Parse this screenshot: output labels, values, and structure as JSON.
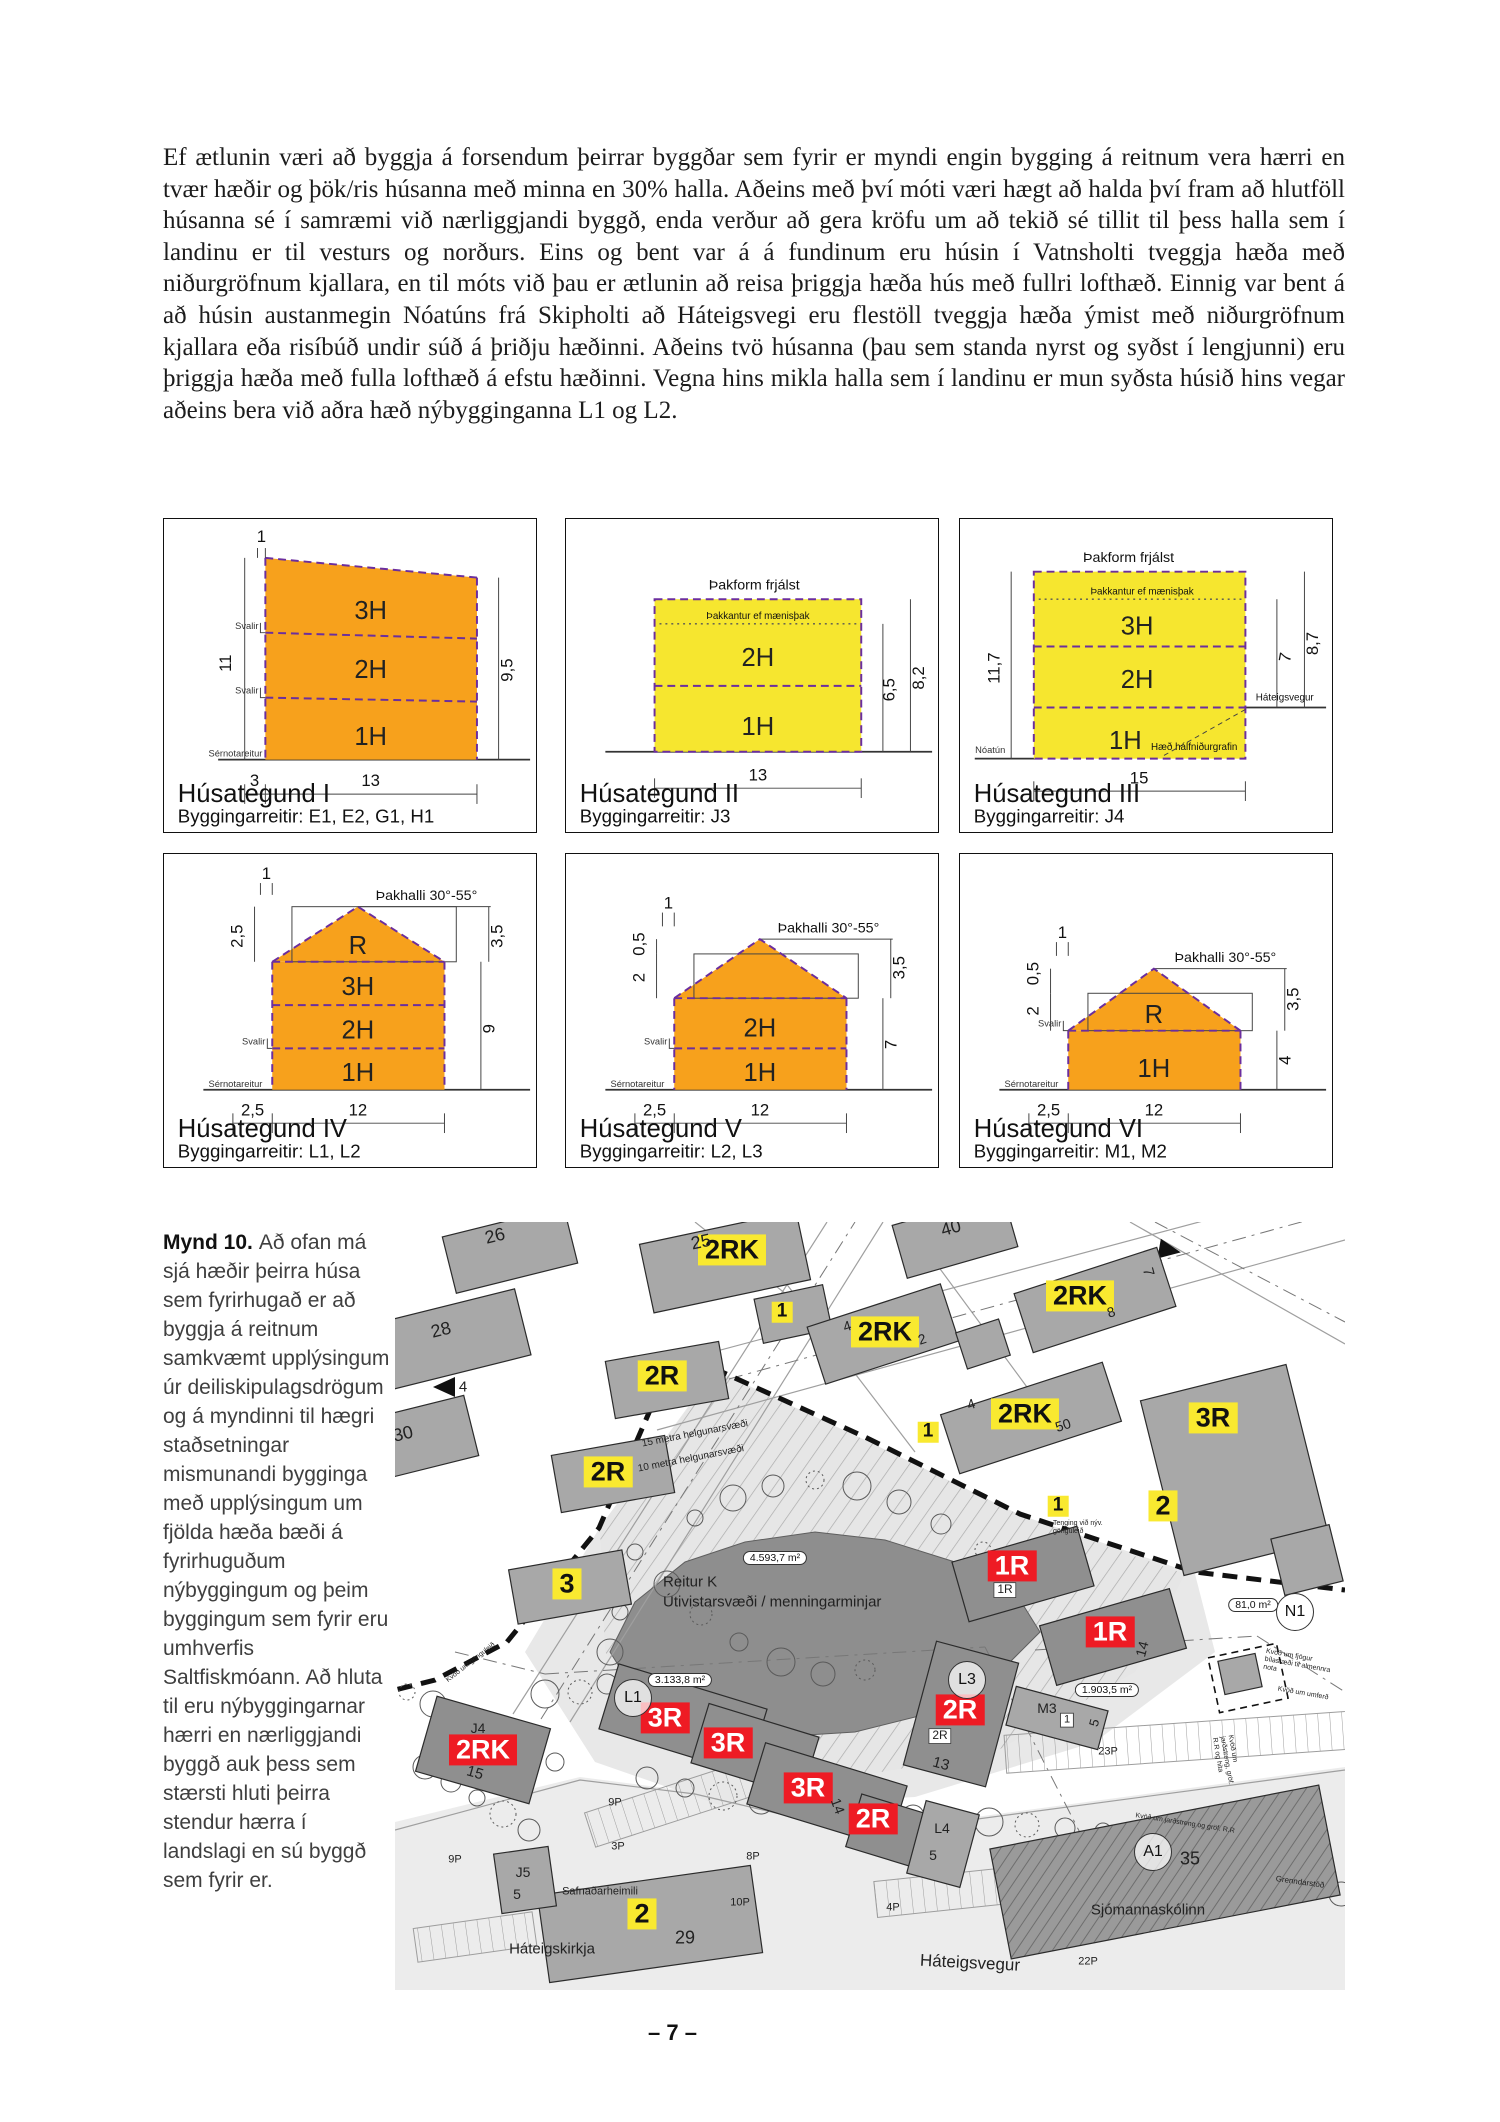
{
  "page": {
    "number": "– 7 –"
  },
  "paragraph": "Ef ætlunin væri að byggja á forsendum þeirrar byggðar sem fyrir er myndi engin bygging á reitnum vera hærri en tvær hæðir og þök/ris húsanna með minna en 30% halla. Aðeins með því móti væri hægt að halda því fram að hlutföll húsanna sé í samræmi við nærliggjandi byggð, enda verður að gera kröfu um að tekið sé tillit til þess halla sem í landinu er til vesturs og norðurs. Eins og bent var á á fundinum eru húsin í Vatnsholti tveggja hæða með niðurgröfnum kjallara, en til móts við þau er ætlunin að reisa þriggja hæða hús með fullri lofthæð. Einnig var bent á að húsin austanmegin Nóatúns frá Skipholti að Háteigsvegi eru flestöll tveggja hæða ýmist með niðurgröfnum kjallara eða risíbúð undir súð á þriðju hæðinni. Aðeins tvö húsanna (þau sem standa nyrst og syðst í lengjunni) eru þriggja hæða með fulla lofthæð á efstu hæðinni. Vegna hins mikla halla sem í landinu er mun syðsta húsið hins vegar aðeins bera við aðra hæð nýbygginganna L1 og L2.",
  "colors": {
    "orange": "#F7A11C",
    "yellow": "#F6E62F",
    "marker_yellow": "#F9E930",
    "marker_red": "#EE1B24",
    "dash_purple": "#6B2E9E"
  },
  "panels": [
    {
      "title": "Húsategund I",
      "subtitle": "Byggingarreitir: E1, E2, G1, H1",
      "floors": [
        "3H",
        "2H",
        "1H"
      ],
      "labels": {
        "top": "1",
        "left": "11",
        "right": "9,5",
        "bottom_left": "3",
        "bottom": "13",
        "svalir": "Svalir",
        "svalir2": "Svalir",
        "sernotareitur": "Sérnotareitur"
      }
    },
    {
      "title": "Húsategund II",
      "subtitle": "Byggingarreitir: J3",
      "floors": [
        "2H",
        "1H"
      ],
      "labels": {
        "roof_note": "Þakform frjálst",
        "edge_note": "Þakkantur ef mænisþak",
        "dim1": "6,5",
        "dim2": "8,2",
        "bottom": "13"
      }
    },
    {
      "title": "Húsategund III",
      "subtitle": "Byggingarreitir: J4",
      "floors": [
        "3H",
        "2H",
        "1H"
      ],
      "labels": {
        "roof_note": "Þakform frjálst",
        "edge_note": "Þakkantur ef mænisþak",
        "left": "11,7",
        "dim1": "7",
        "dim2": "8,7",
        "bottom": "15",
        "street_left": "Nóatún",
        "street_right": "Háteigsvegur",
        "basement_note": "Hæð hálfniðurgrafin"
      }
    },
    {
      "title": "Húsategund IV",
      "subtitle": "Byggingarreitir: L1, L2",
      "floors": [
        "R",
        "3H",
        "2H",
        "1H"
      ],
      "labels": {
        "top": "1",
        "roof_note": "Þakhalli 30°-55°",
        "left1": "2,5",
        "right1": "3,5",
        "right2": "9",
        "bottom_left": "2,5",
        "bottom": "12",
        "svalir": "Svalir",
        "sernotareitur": "Sérnotareitur"
      }
    },
    {
      "title": "Húsategund V",
      "subtitle": "Byggingarreitir: L2, L3",
      "floors": [
        "2H",
        "1H"
      ],
      "labels": {
        "top": "1",
        "roof_note": "Þakhalli 30°-55°",
        "left1": "0,5",
        "left2": "2",
        "right1": "3,5",
        "right2": "7",
        "bottom_left": "2,5",
        "bottom": "12",
        "svalir": "Svalir",
        "sernotareitur": "Sérnotareitur"
      }
    },
    {
      "title": "Húsategund VI",
      "subtitle": "Byggingarreitir: M1, M2",
      "floors": [
        "R",
        "1H"
      ],
      "labels": {
        "top": "1",
        "roof_note": "Þakhalli 30°-55°",
        "left1": "0,5",
        "left2": "2",
        "right1": "3,5",
        "right2": "4",
        "bottom_left": "2,5",
        "bottom": "12",
        "svalir": "Svalir",
        "sernotareitur": "Sérnotareitur"
      }
    }
  ],
  "figure": {
    "label": "Mynd 10.",
    "text": "Að ofan má sjá hæðir þeirra húsa sem fyrirhugað er að byggja á reitnum samkvæmt upplýsingum úr deiliskipulagsdrögum og á myndinni til hægri staðsetningar mismunandi bygginga með upplýsingum um fjölda hæða bæði á fyrirhuguðum nýbyggingum og þeim byggingum sem fyrir eru umhverfis Saltfiskmóann. Að hluta til eru nýbyggingarnar hærri en nærliggjandi byggð auk þess sem stærsti hluti þeirra stendur hærra í landslagi en sú byggð sem fyrir er."
  },
  "map": {
    "buildings": [
      {
        "x": 115,
        "y": 28,
        "w": 125,
        "h": 58,
        "r": -14
      },
      {
        "x": 55,
        "y": 118,
        "w": 150,
        "h": 68,
        "r": -14
      },
      {
        "x": 18,
        "y": 218,
        "w": 120,
        "h": 62,
        "r": -14
      },
      {
        "x": 330,
        "y": 40,
        "w": 160,
        "h": 70,
        "r": -12
      },
      {
        "x": 398,
        "y": 92,
        "w": 70,
        "h": 45,
        "r": -12
      },
      {
        "x": 560,
        "y": 14,
        "w": 115,
        "h": 55,
        "r": -16
      },
      {
        "x": 488,
        "y": 112,
        "w": 140,
        "h": 60,
        "r": -18
      },
      {
        "x": 700,
        "y": 78,
        "w": 150,
        "h": 62,
        "r": -18
      },
      {
        "x": 588,
        "y": 122,
        "w": 45,
        "h": 38,
        "r": -18
      },
      {
        "x": 636,
        "y": 196,
        "w": 170,
        "h": 62,
        "r": -18
      },
      {
        "x": 272,
        "y": 158,
        "w": 115,
        "h": 58,
        "r": -10
      },
      {
        "x": 218,
        "y": 252,
        "w": 115,
        "h": 58,
        "r": -10
      },
      {
        "x": 175,
        "y": 365,
        "w": 115,
        "h": 55,
        "r": -10
      },
      {
        "x": 840,
        "y": 248,
        "w": 150,
        "h": 180,
        "r": -14
      },
      {
        "x": 912,
        "y": 338,
        "w": 60,
        "h": 58,
        "r": -14
      },
      {
        "x": 628,
        "y": 352,
        "w": 130,
        "h": 62,
        "r": -16,
        "f": "#8F8F8F"
      },
      {
        "x": 718,
        "y": 415,
        "w": 135,
        "h": 62,
        "r": -16,
        "f": "#8F8F8F"
      },
      {
        "x": 88,
        "y": 528,
        "w": 118,
        "h": 78,
        "r": 16,
        "f": "#8F8F8F"
      },
      {
        "x": 288,
        "y": 497,
        "w": 155,
        "h": 68,
        "r": 17,
        "f": "#8F8F8F"
      },
      {
        "x": 360,
        "y": 528,
        "w": 115,
        "h": 62,
        "r": 17,
        "f": "#8F8F8F"
      },
      {
        "x": 432,
        "y": 573,
        "w": 148,
        "h": 64,
        "r": 17,
        "f": "#8F8F8F"
      },
      {
        "x": 497,
        "y": 610,
        "w": 80,
        "h": 55,
        "r": 17,
        "f": "#8F8F8F"
      },
      {
        "x": 566,
        "y": 492,
        "w": 85,
        "h": 128,
        "r": 15,
        "f": "#8F8F8F"
      },
      {
        "x": 548,
        "y": 622,
        "w": 55,
        "h": 75,
        "r": 15
      },
      {
        "x": 662,
        "y": 496,
        "w": 95,
        "h": 40,
        "r": 15
      },
      {
        "x": 255,
        "y": 702,
        "w": 215,
        "h": 88,
        "r": -8
      },
      {
        "x": 130,
        "y": 658,
        "w": 55,
        "h": 60,
        "r": -8
      },
      {
        "x": 845,
        "y": 452,
        "w": 38,
        "h": 34,
        "r": -12
      },
      {
        "x": 770,
        "y": 650,
        "w": 335,
        "h": 112,
        "r": -11,
        "hat": true
      }
    ],
    "markers_yellow": [
      {
        "x": 337,
        "y": 28,
        "t": "2RK"
      },
      {
        "x": 490,
        "y": 110,
        "t": "2RK"
      },
      {
        "x": 685,
        "y": 74,
        "t": "2RK"
      },
      {
        "x": 630,
        "y": 192,
        "t": "2RK"
      },
      {
        "x": 387,
        "y": 90,
        "t": "1",
        "sm": true
      },
      {
        "x": 533,
        "y": 210,
        "t": "1",
        "sm": true
      },
      {
        "x": 663,
        "y": 284,
        "t": "1",
        "sm": true
      },
      {
        "x": 267,
        "y": 154,
        "t": "2R"
      },
      {
        "x": 213,
        "y": 250,
        "t": "2R"
      },
      {
        "x": 172,
        "y": 362,
        "t": "3"
      },
      {
        "x": 818,
        "y": 196,
        "t": "3R"
      },
      {
        "x": 768,
        "y": 284,
        "t": "2"
      },
      {
        "x": 247,
        "y": 692,
        "t": "2"
      }
    ],
    "markers_red": [
      {
        "x": 617,
        "y": 344,
        "t": "1R"
      },
      {
        "x": 715,
        "y": 410,
        "t": "1R"
      },
      {
        "x": 88,
        "y": 528,
        "t": "2RK"
      },
      {
        "x": 270,
        "y": 496,
        "t": "3R"
      },
      {
        "x": 333,
        "y": 521,
        "t": "3R"
      },
      {
        "x": 413,
        "y": 566,
        "t": "3R"
      },
      {
        "x": 478,
        "y": 597,
        "t": "2R"
      },
      {
        "x": 565,
        "y": 488,
        "t": "2R"
      }
    ],
    "circle_labels": [
      {
        "x": 238,
        "y": 476,
        "t": "L1"
      },
      {
        "x": 572,
        "y": 458,
        "t": "L3"
      },
      {
        "x": 758,
        "y": 630,
        "t": "A1"
      },
      {
        "x": 900,
        "y": 390,
        "t": "N1"
      }
    ],
    "area_labels": [
      {
        "x": 380,
        "y": 336,
        "t": "4.593,7 m²"
      },
      {
        "x": 285,
        "y": 458,
        "t": "3.133,8 m²"
      },
      {
        "x": 712,
        "y": 468,
        "t": "1.903,5 m²"
      },
      {
        "x": 858,
        "y": 383,
        "t": "81,0 m²"
      }
    ],
    "texts": [
      {
        "x": 100,
        "y": 14,
        "t": "26",
        "s": 18,
        "r": -14
      },
      {
        "x": 46,
        "y": 108,
        "t": "28",
        "s": 18,
        "r": -14
      },
      {
        "x": 8,
        "y": 212,
        "t": "30",
        "s": 18,
        "r": -14
      },
      {
        "x": 306,
        "y": 20,
        "t": "25",
        "s": 18,
        "r": -12
      },
      {
        "x": 556,
        "y": 6,
        "t": "40",
        "s": 18,
        "r": -16
      },
      {
        "x": 452,
        "y": 104,
        "t": "4",
        "s": 14,
        "r": -18
      },
      {
        "x": 527,
        "y": 117,
        "t": "2",
        "s": 14,
        "r": -18
      },
      {
        "x": 576,
        "y": 182,
        "t": "4",
        "s": 14,
        "r": -18
      },
      {
        "x": 668,
        "y": 203,
        "t": "50",
        "s": 14,
        "r": -18
      },
      {
        "x": 716,
        "y": 90,
        "t": "8",
        "s": 14,
        "r": -18
      },
      {
        "x": 68,
        "y": 165,
        "t": "4",
        "s": 15
      },
      {
        "x": 753,
        "y": 50,
        "t": "7",
        "s": 15,
        "r": 75
      },
      {
        "x": 300,
        "y": 212,
        "t": "15 metra helgunarsvæði",
        "s": 10,
        "r": -11
      },
      {
        "x": 296,
        "y": 237,
        "t": "10 metra helgunarsvæði",
        "s": 10,
        "r": -11
      },
      {
        "x": 268,
        "y": 360,
        "t": "Reitur K",
        "s": 15,
        "a": "l"
      },
      {
        "x": 268,
        "y": 380,
        "t": "Útivistarsvæði / menningarminjar",
        "s": 15,
        "a": "l"
      },
      {
        "x": 610,
        "y": 368,
        "t": "1R",
        "s": 12,
        "k": "box"
      },
      {
        "x": 545,
        "y": 514,
        "t": "2R",
        "s": 12,
        "k": "box"
      },
      {
        "x": 672,
        "y": 498,
        "t": "1",
        "s": 11,
        "k": "box"
      },
      {
        "x": 83,
        "y": 506,
        "t": "J4",
        "s": 14
      },
      {
        "x": 80,
        "y": 551,
        "t": "15",
        "s": 15,
        "r": 16
      },
      {
        "x": 546,
        "y": 542,
        "t": "13",
        "s": 15,
        "r": 15
      },
      {
        "x": 652,
        "y": 486,
        "t": "M3",
        "s": 14
      },
      {
        "x": 700,
        "y": 501,
        "t": "5",
        "s": 13,
        "r": -75
      },
      {
        "x": 747,
        "y": 427,
        "t": "14",
        "s": 14,
        "r": -75
      },
      {
        "x": 443,
        "y": 584,
        "t": "14",
        "s": 14,
        "r": 70
      },
      {
        "x": 547,
        "y": 606,
        "t": "L4",
        "s": 14
      },
      {
        "x": 538,
        "y": 633,
        "t": "5",
        "s": 14
      },
      {
        "x": 128,
        "y": 650,
        "t": "J5",
        "s": 14
      },
      {
        "x": 122,
        "y": 672,
        "t": "5",
        "s": 14
      },
      {
        "x": 795,
        "y": 637,
        "t": "35",
        "s": 18
      },
      {
        "x": 290,
        "y": 716,
        "t": "29",
        "s": 18
      },
      {
        "x": 220,
        "y": 581,
        "t": "9P",
        "s": 11
      },
      {
        "x": 60,
        "y": 638,
        "t": "9P",
        "s": 11
      },
      {
        "x": 223,
        "y": 625,
        "t": "3P",
        "s": 11
      },
      {
        "x": 358,
        "y": 635,
        "t": "8P",
        "s": 11
      },
      {
        "x": 345,
        "y": 681,
        "t": "10P",
        "s": 11
      },
      {
        "x": 713,
        "y": 530,
        "t": "23P",
        "s": 11
      },
      {
        "x": 498,
        "y": 686,
        "t": "4P",
        "s": 11
      },
      {
        "x": 693,
        "y": 740,
        "t": "22P",
        "s": 11
      },
      {
        "x": 205,
        "y": 670,
        "t": "Safnaðarheimili",
        "s": 11
      },
      {
        "x": 157,
        "y": 727,
        "t": "Háteigskirkja",
        "s": 15
      },
      {
        "x": 753,
        "y": 688,
        "t": "Sjómannaskólinn",
        "s": 15
      },
      {
        "x": 575,
        "y": 741,
        "t": "Háteigsvegur",
        "s": 17,
        "r": 3
      },
      {
        "x": 688,
        "y": 306,
        "t": "Tenging við nýv. gönguleið",
        "s": 7,
        "w": 60,
        "k": "wrap"
      },
      {
        "x": 905,
        "y": 444,
        "t": "Kvöð um fjögur bílastæði til almennra nota",
        "s": 7,
        "r": 10,
        "w": 72,
        "k": "wrap"
      },
      {
        "x": 908,
        "y": 472,
        "t": "Kvöð um umferð",
        "s": 7,
        "r": 10
      },
      {
        "x": 790,
        "y": 602,
        "t": "Kvöð um jarðstreng og gröf. R.R",
        "s": 7,
        "r": 9
      },
      {
        "x": 832,
        "y": 545,
        "t": "Kvöð um jarðstreng, gröf. R.R og hita",
        "s": 7,
        "r": 80,
        "w": 62,
        "k": "wrap"
      },
      {
        "x": 905,
        "y": 660,
        "t": "Grenndarstöð",
        "s": 8,
        "r": 8
      },
      {
        "x": 76,
        "y": 441,
        "t": "Kvöð um gönguleið",
        "s": 7,
        "r": -38
      }
    ]
  }
}
